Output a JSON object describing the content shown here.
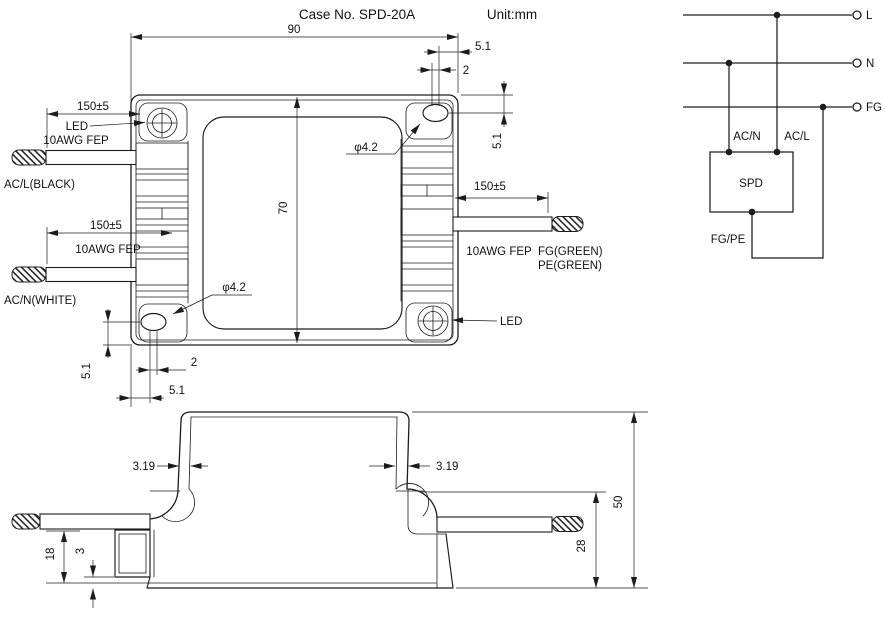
{
  "header": {
    "case_no": "Case No. SPD-20A",
    "unit": "Unit:mm"
  },
  "top_view": {
    "dim_width": "90",
    "dim_height": "70",
    "dim_slot_edge": "5.1",
    "dim_slot_pitch": "2",
    "wire_length": "150±5",
    "hole_dia": "φ4.2",
    "led": "LED",
    "wire_gauge": "10AWG FEP",
    "wire_acl": "AC/L(BLACK)",
    "wire_acn": "AC/N(WHITE)",
    "wire_fg": "FG(GREEN)",
    "wire_pe": "PE(GREEN)"
  },
  "side_view": {
    "dim_wall": "3.19",
    "dim_total_height": "50",
    "dim_wire_height": "28",
    "dim_lead": "18",
    "dim_foot": "3"
  },
  "circuit": {
    "line_l": "L",
    "line_n": "N",
    "line_fg": "FG",
    "in_acn": "AC/N",
    "in_acl": "AC/L",
    "device": "SPD",
    "ground": "FG/PE"
  },
  "colors": {
    "line": "#1c1c1c",
    "background": "#ffffff"
  }
}
